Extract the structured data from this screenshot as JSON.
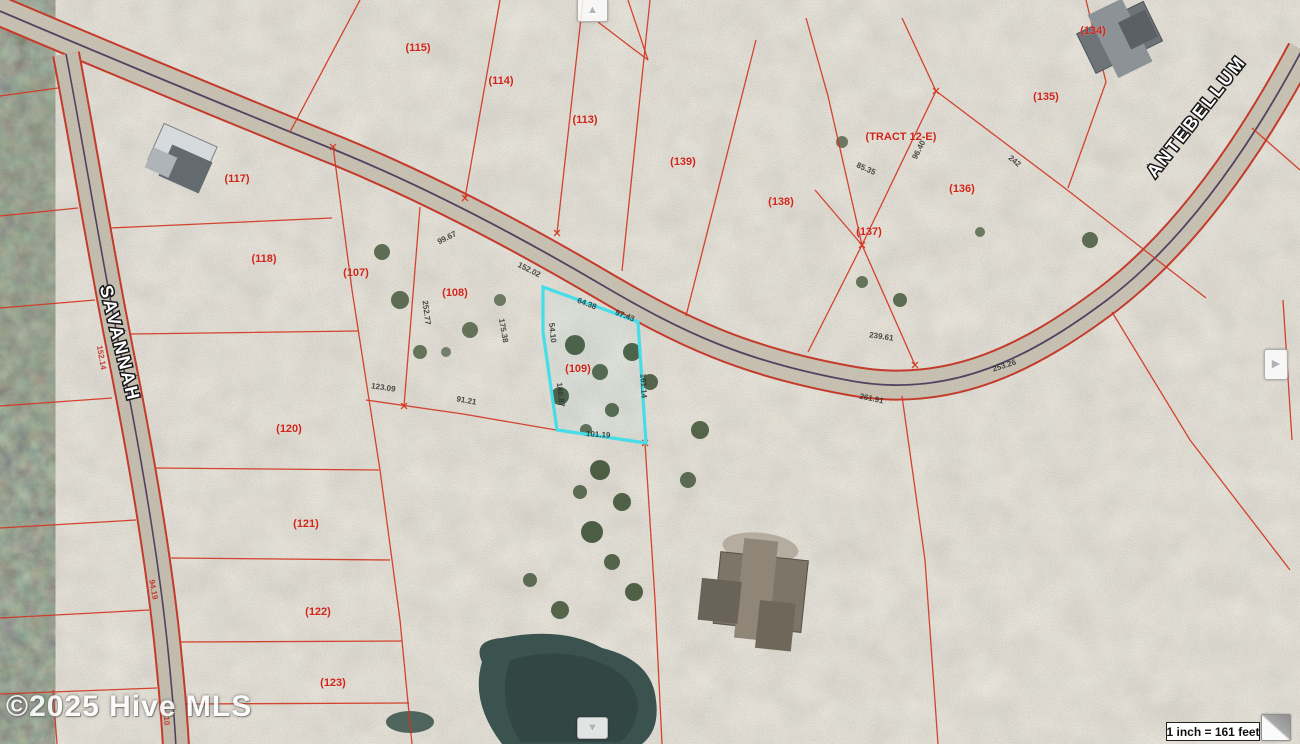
{
  "map": {
    "watermark": "©2025 Hive MLS",
    "scale_label": "1 inch = 161 feet",
    "highlighted_parcel": "(109)",
    "colors": {
      "boundary_line": "#d23522",
      "highlight_outline": "#45dde8",
      "parcel_label": "#cf2418",
      "road_centerline": "#3b2750"
    },
    "controls": {
      "up": "▲",
      "down": "▼",
      "right": "▶"
    },
    "roads": [
      {
        "name": "SAVANNAH",
        "x": 114,
        "y": 345,
        "rotation": 76
      },
      {
        "name": "ANTEBELLUM",
        "x": 1201,
        "y": 120,
        "rotation": -52
      }
    ],
    "parcels": [
      {
        "label": "(115)",
        "x": 418,
        "y": 51
      },
      {
        "label": "(114)",
        "x": 501,
        "y": 84
      },
      {
        "label": "(113)",
        "x": 585,
        "y": 123
      },
      {
        "label": "(139)",
        "x": 683,
        "y": 165
      },
      {
        "label": "(138)",
        "x": 781,
        "y": 205
      },
      {
        "label": "(137)",
        "x": 869,
        "y": 235
      },
      {
        "label": "(TRACT 12-E)",
        "x": 901,
        "y": 140
      },
      {
        "label": "(136)",
        "x": 962,
        "y": 192
      },
      {
        "label": "(135)",
        "x": 1046,
        "y": 100
      },
      {
        "label": "(134)",
        "x": 1093,
        "y": 34
      },
      {
        "label": "(117)",
        "x": 237,
        "y": 182
      },
      {
        "label": "(118)",
        "x": 264,
        "y": 262
      },
      {
        "label": "(107)",
        "x": 356,
        "y": 276
      },
      {
        "label": "(108)",
        "x": 455,
        "y": 296
      },
      {
        "label": "(109)",
        "x": 578,
        "y": 372,
        "highlighted": true
      },
      {
        "label": "(120)",
        "x": 289,
        "y": 432
      },
      {
        "label": "(121)",
        "x": 306,
        "y": 527
      },
      {
        "label": "(122)",
        "x": 318,
        "y": 615
      },
      {
        "label": "(123)",
        "x": 333,
        "y": 686
      }
    ],
    "dimensions": [
      {
        "text": "252.77",
        "x": 424,
        "y": 313,
        "rot": 83
      },
      {
        "text": "175.38",
        "x": 501,
        "y": 331,
        "rot": 80
      },
      {
        "text": "123.09",
        "x": 383,
        "y": 390,
        "rot": 8
      },
      {
        "text": "91.21",
        "x": 466,
        "y": 403,
        "rot": 10
      },
      {
        "text": "99.67",
        "x": 448,
        "y": 240,
        "rot": -27
      },
      {
        "text": "152.02",
        "x": 528,
        "y": 272,
        "rot": 27
      },
      {
        "text": "54.10",
        "x": 550,
        "y": 333,
        "rot": 84
      },
      {
        "text": "140.87",
        "x": 558,
        "y": 395,
        "rot": 84
      },
      {
        "text": "64.38",
        "x": 586,
        "y": 306,
        "rot": 21
      },
      {
        "text": "97.43",
        "x": 624,
        "y": 318,
        "rot": 21
      },
      {
        "text": "161.14",
        "x": 641,
        "y": 386,
        "rot": 87
      },
      {
        "text": "101.19",
        "x": 598,
        "y": 437,
        "rot": 4
      },
      {
        "text": "85.35",
        "x": 865,
        "y": 171,
        "rot": 24
      },
      {
        "text": "96.40",
        "x": 921,
        "y": 151,
        "rot": -63
      },
      {
        "text": "242",
        "x": 1013,
        "y": 163,
        "rot": 40
      },
      {
        "text": "239.61",
        "x": 881,
        "y": 339,
        "rot": 8
      },
      {
        "text": "253.26",
        "x": 1005,
        "y": 368,
        "rot": -18
      },
      {
        "text": "261.91",
        "x": 871,
        "y": 401,
        "rot": 12
      },
      {
        "text": "110",
        "x": 164,
        "y": 719,
        "rot": 85,
        "red": true
      },
      {
        "text": "152.14",
        "x": 99,
        "y": 358,
        "rot": 80,
        "red": true
      },
      {
        "text": "94.19",
        "x": 151,
        "y": 590,
        "rot": 80,
        "red": true
      }
    ]
  }
}
